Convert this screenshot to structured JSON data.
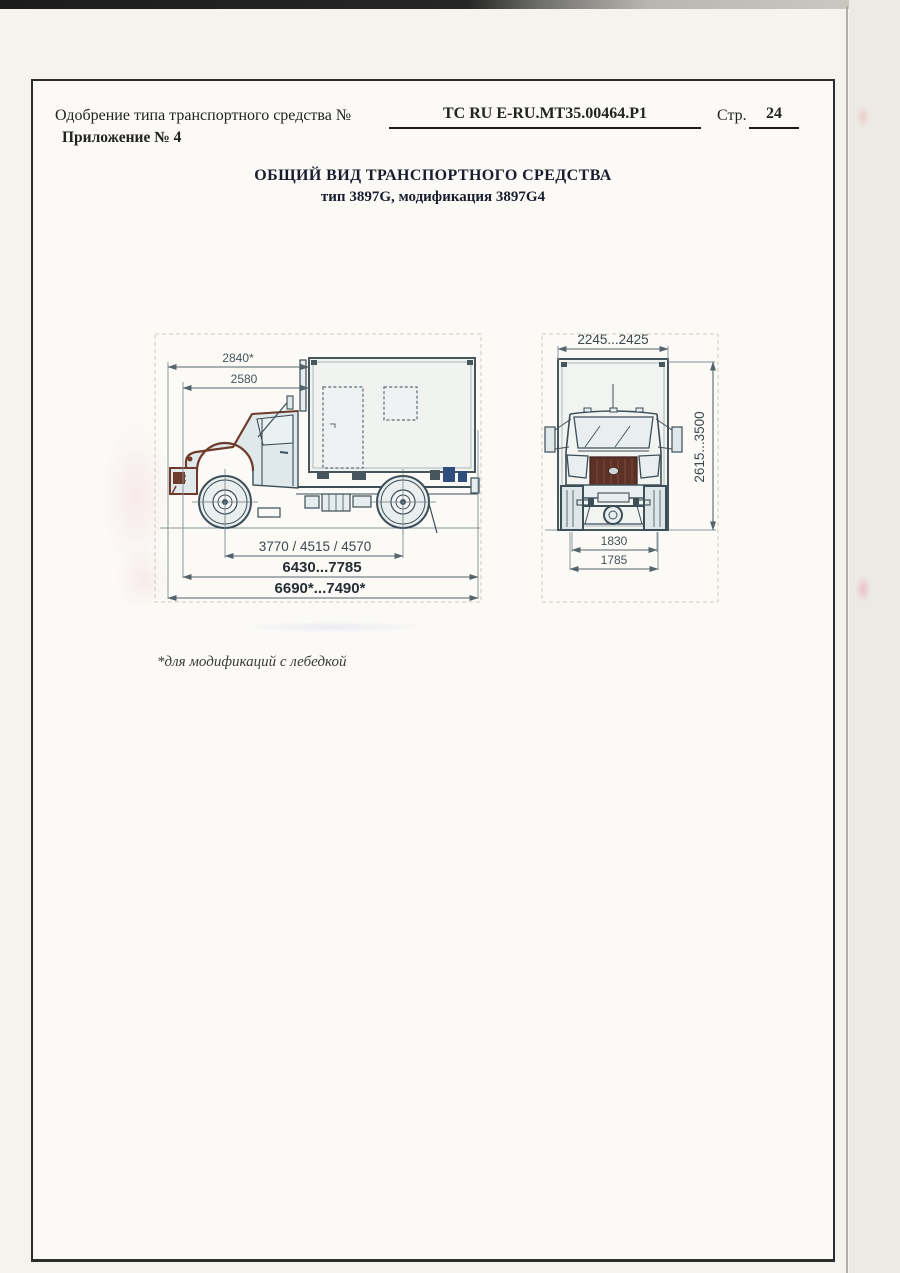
{
  "header": {
    "approval_label": "Одобрение типа транспортного средства №",
    "approval_number": "ТС RU E-RU.MT35.00464.P1",
    "page_label": "Стр.",
    "page_number": "24",
    "attachment_label": "Приложение № 4"
  },
  "title": {
    "line1": "ОБЩИЙ ВИД ТРАНСПОРТНОГО СРЕДСТВА",
    "line2": "тип 3897G, модификация 3897G4"
  },
  "footnote": "*для модификаций с лебедкой",
  "drawing": {
    "description": "General view drawing of truck type 3897G (side view and front view) with overall dimensions in mm",
    "side": {
      "dim_top_winch": "2840*",
      "dim_top": "2580",
      "dim_wheelbase": "3770 / 4515 / 4570",
      "dim_overall": "6430...7785",
      "dim_overall_winch": "6690*...7490*"
    },
    "front": {
      "dim_width": "2245...2425",
      "dim_height": "2615...3500",
      "dim_track_outer": "1830",
      "dim_track": "1785"
    },
    "colors": {
      "line": "#3c4e57",
      "accent": "#6f3b2b",
      "dim_line": "#55646a",
      "paper": "#fbfaf7"
    }
  }
}
